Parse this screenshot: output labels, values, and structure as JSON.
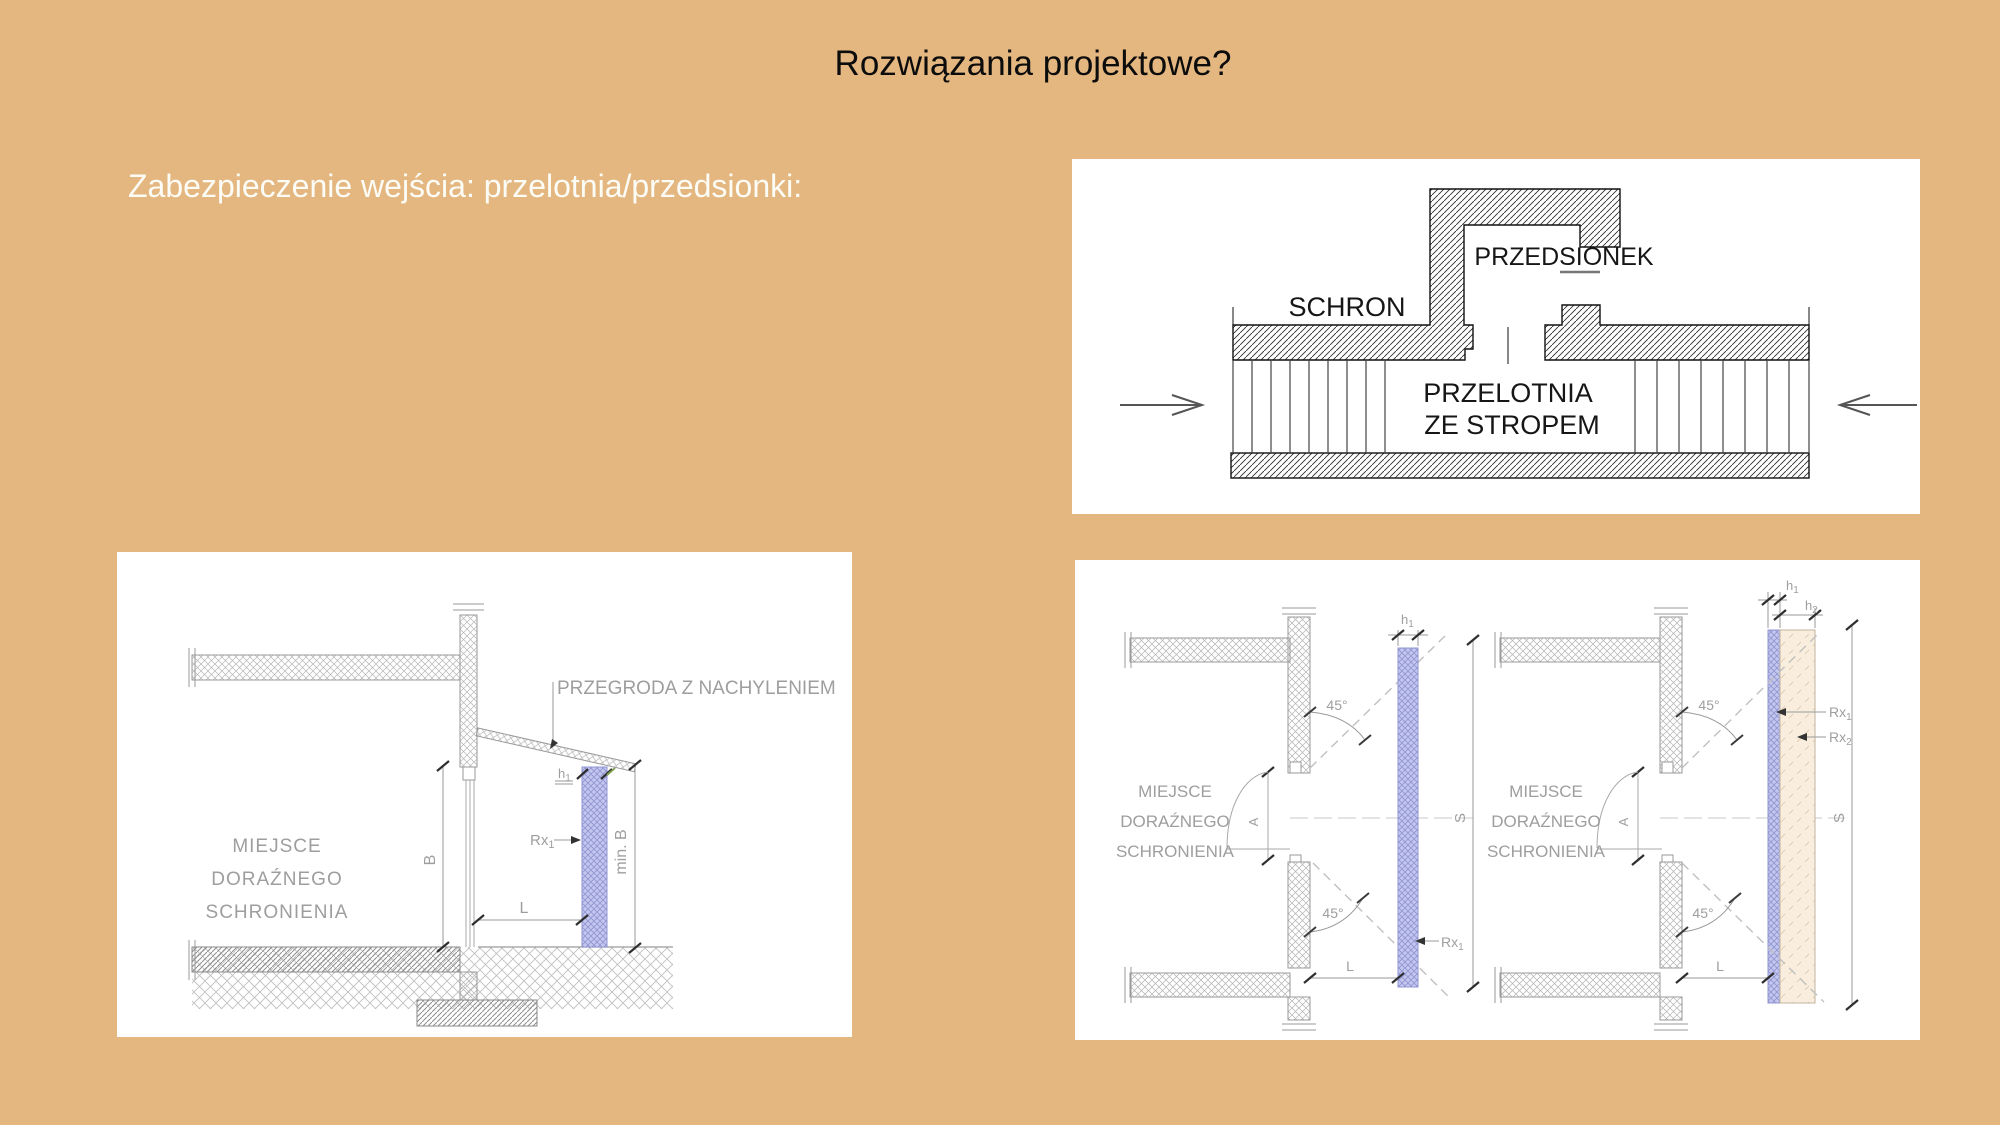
{
  "slide": {
    "title": "Rozwiązania projektowe?",
    "subtitle": "Zabezpieczenie wejścia: przelotnia/przedsionki:"
  },
  "colors": {
    "background": "#e5b780",
    "panel": "#ffffff",
    "screen_blue": "#c3c6ee",
    "screen_blue_line": "#8f94d0",
    "screen_beige": "#f9eedd"
  },
  "top_right_diagram": {
    "schron": "SCHRON",
    "przedsionek": "PRZEDSIONEK",
    "przelotnia_line1": "PRZELOTNIA",
    "przelotnia_line2": "ZE STROPEM"
  },
  "bottom_left_diagram": {
    "przegroda": "PRZEGRODA Z NACHYLENIEM",
    "miejsce1": "MIEJSCE",
    "miejsce2": "DORAŹNEGO",
    "miejsce3": "SCHRONIENIA",
    "dim_b": "B",
    "dim_min_b": "min. B",
    "dim_l": "L",
    "h": {
      "base": "h",
      "sub": "1"
    },
    "rx": {
      "base": "Rx",
      "sub": "1"
    }
  },
  "bottom_right_diagram": {
    "left_view": {
      "miejsce1": "MIEJSCE",
      "miejsce2": "DORAŹNEGO",
      "miejsce3": "SCHRONIENIA",
      "angle_top": "45°",
      "angle_bottom": "45°",
      "door_angle": "A",
      "h": {
        "base": "h",
        "sub": "1"
      },
      "s": "S",
      "rx": {
        "base": "Rx",
        "sub": "1"
      },
      "l": "L"
    },
    "right_view": {
      "miejsce1": "MIEJSCE",
      "miejsce2": "DORAŹNEGO",
      "miejsce3": "SCHRONIENIA",
      "angle_top": "45°",
      "angle_bottom": "45°",
      "door_angle": "A",
      "h1": {
        "base": "h",
        "sub": "1"
      },
      "h2": {
        "base": "h",
        "sub": "2"
      },
      "s": "S",
      "rx1": {
        "base": "Rx",
        "sub": "1"
      },
      "rx2": {
        "base": "Rx",
        "sub": "2"
      },
      "l": "L"
    }
  }
}
